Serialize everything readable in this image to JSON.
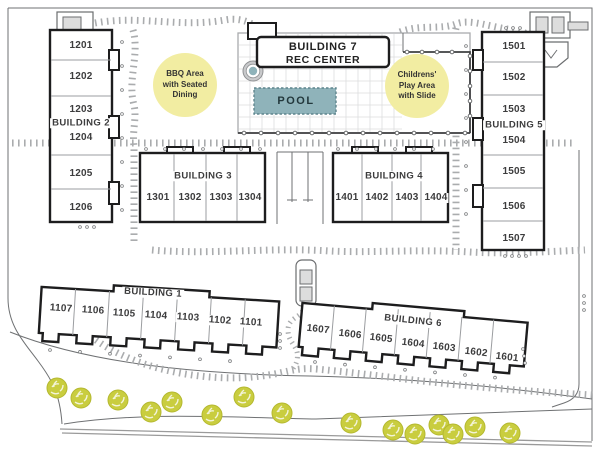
{
  "legend": {
    "bbq_area": "BBQ Area\nwith Seated\nDining",
    "play_area": "Childrens'\nPlay Area\nwith Slide"
  },
  "facilities": {
    "rec_center_line1": "BUILDING 7",
    "rec_center_line2": "REC CENTER",
    "pool": "POOL"
  },
  "buildings": [
    {
      "name": "BUILDING 1",
      "units": [
        "1107",
        "1106",
        "1105",
        "1104",
        "1103",
        "1102",
        "1101"
      ]
    },
    {
      "name": "BUILDING 2",
      "units": [
        "1201",
        "1202",
        "1203",
        "1204",
        "1205",
        "1206"
      ]
    },
    {
      "name": "BUILDING 3",
      "units": [
        "1301",
        "1302",
        "1303",
        "1304"
      ]
    },
    {
      "name": "BUILDING 4",
      "units": [
        "1401",
        "1402",
        "1403",
        "1404"
      ]
    },
    {
      "name": "BUILDING 5",
      "units": [
        "1501",
        "1502",
        "1503",
        "1504",
        "1505",
        "1506",
        "1507"
      ]
    },
    {
      "name": "BUILDING 6",
      "units": [
        "1607",
        "1606",
        "1605",
        "1604",
        "1603",
        "1602",
        "1601"
      ]
    }
  ],
  "colors": {
    "pool_fill": "#8fb3ba",
    "pool_edge": "#5f858d",
    "area_highlight": "#f2eda2",
    "tree": "#c9cd3f",
    "outline": "#1d1d1e",
    "text": "#3c3c3d"
  }
}
